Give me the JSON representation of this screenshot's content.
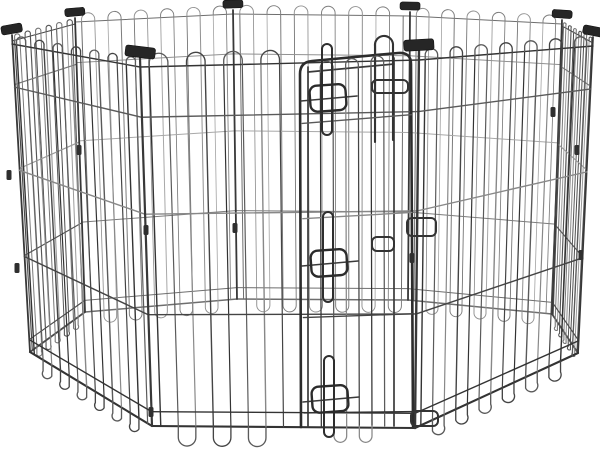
{
  "scene": {
    "background": "#ffffff",
    "subject": "Black foldable metal wire octagonal pet exercise pen, 8 panels with looped wire tops and feet, black plastic corner clips, and a step-through wire door secured by three slide-bolt latches - studio product photo on a white background",
    "panel_count": 8,
    "corner_clip_count": 8,
    "door_latch_count": 3,
    "clip_color": "#262626",
    "wire_dark": "#333333",
    "wire_light": "#999999"
  },
  "pen": {
    "clip_color": "#262626",
    "post_color": "#383838",
    "door_frame_color": "#2c2c2c",
    "latch_color": "#2b2b2b",
    "vertices": {
      "V1": [
        140,
        54
      ],
      "V2": [
        12,
        31
      ],
      "V3": [
        75,
        14
      ],
      "V4": [
        233,
        6
      ],
      "V5": [
        410,
        8
      ],
      "V6": [
        562,
        16
      ],
      "V7": [
        593,
        33
      ],
      "V8": [
        419,
        47
      ],
      "B1": [
        152,
        426
      ],
      "B2": [
        30,
        352
      ],
      "B3": [
        85,
        312
      ],
      "B4": [
        237,
        299
      ],
      "B5": [
        408,
        300
      ],
      "B6": [
        552,
        314
      ],
      "B7": [
        578,
        353
      ],
      "B8": [
        415,
        428
      ]
    },
    "horizontal_fractions": [
      0.14,
      0.41,
      0.69,
      0.96
    ],
    "depths": {
      "front": {
        "base": 13,
        "arc": 4,
        "foot": 11,
        "w": 1.4
      },
      "side": {
        "base": 10,
        "arc": 3,
        "foot": 8,
        "w": 1.15
      },
      "back": {
        "base": 8,
        "arc": 2,
        "foot": 6,
        "w": 1.0
      }
    },
    "palettes": {
      "front": [
        "#333333",
        "#5a5a5a",
        "#888888",
        "#444444"
      ],
      "side": [
        "#4a4a4a",
        "#777777",
        "#999999",
        "#555555"
      ],
      "back": [
        "#6e6e6e",
        "#919191",
        "#a8a8a8",
        "#7c7c7c"
      ]
    },
    "panels_rear": [
      {
        "name": "back-left",
        "a": "V3",
        "b": "V4",
        "ab": "B3",
        "bb": "B4",
        "wires": 12,
        "depth": "back"
      },
      {
        "name": "back-center",
        "a": "V4",
        "b": "V5",
        "ab": "B4",
        "bb": "B5",
        "wires": 13,
        "depth": "back"
      },
      {
        "name": "back-right",
        "a": "V5",
        "b": "V6",
        "ab": "B5",
        "bb": "B6",
        "wires": 12,
        "depth": "back"
      },
      {
        "name": "left-side",
        "a": "V2",
        "b": "V3",
        "ab": "B2",
        "bb": "B3",
        "wires": 12,
        "depth": "side"
      },
      {
        "name": "right-side",
        "a": "V6",
        "b": "V7",
        "ab": "B6",
        "bb": "B7",
        "wires": 12,
        "depth": "side"
      }
    ],
    "panels_front": [
      {
        "name": "front-left",
        "a": "V2",
        "b": "V1",
        "ab": "B2",
        "bb": "B1",
        "wires": 14,
        "depth": "front"
      },
      {
        "name": "front-right",
        "a": "V8",
        "b": "V7",
        "ab": "B8",
        "bb": "B7",
        "wires": 14,
        "depth": "front"
      },
      {
        "name": "front-door",
        "a": "V1",
        "b": "V8",
        "ab": "B1",
        "bb": "B8",
        "wires": 15,
        "depth": "front",
        "cut": [
          296,
          417
        ]
      }
    ],
    "posts_rear": [
      {
        "v": "V3",
        "b": "B3"
      },
      {
        "v": "V4",
        "b": "B4"
      },
      {
        "v": "V5",
        "b": "B5"
      },
      {
        "v": "V6",
        "b": "B6"
      },
      {
        "v": "V2",
        "b": "B2"
      },
      {
        "v": "V7",
        "b": "B7"
      }
    ],
    "posts_front": [
      {
        "v": "V1",
        "b": "B1",
        "wd": 2.2
      },
      {
        "v": "V8",
        "b": "B8",
        "wd": 2.4
      }
    ],
    "door": {
      "frame_path": "M 301 427 L 300 74 Q 300 62 312 61 L 398 53 Q 411 52 411 64 L 413 426",
      "inner_lines": [
        [
          308,
          67,
          308,
          427
        ],
        [
          394,
          58,
          394,
          426
        ],
        [
          308,
          72,
          394,
          64
        ]
      ],
      "tall_loop_path": "M 375 142 L 375 46 A 9 9 0 0 1 393 44 L 393 140",
      "wires": 6,
      "wire_span": [
        314,
        390
      ],
      "wire_top": [
        73,
        65
      ],
      "wire_bottom": 426,
      "keepers": [
        [
          372,
          80,
          408,
          93
        ],
        [
          407,
          218,
          436,
          236
        ],
        [
          372,
          237,
          394,
          251
        ],
        [
          411,
          411,
          438,
          426
        ]
      ],
      "latches": [
        {
          "cx": 327,
          "keeper_y": 98,
          "bolt_top": 44,
          "bolt_bottom": 135
        },
        {
          "cx": 328,
          "keeper_y": 263,
          "bolt_top": 212,
          "bolt_bottom": 302
        },
        {
          "cx": 329,
          "keeper_y": 399,
          "bolt_top": 356,
          "bolt_bottom": 437
        }
      ]
    },
    "top_clips": [
      {
        "v": "V1",
        "w": 30,
        "h": 11,
        "angle": 7
      },
      {
        "v": "V2",
        "w": 21,
        "h": 9,
        "angle": -10
      },
      {
        "v": "V3",
        "w": 20,
        "h": 8,
        "angle": -5
      },
      {
        "v": "V4",
        "w": 20,
        "h": 8,
        "angle": -2
      },
      {
        "v": "V5",
        "w": 20,
        "h": 8,
        "angle": 1
      },
      {
        "v": "V6",
        "w": 20,
        "h": 8,
        "angle": 4
      },
      {
        "v": "V7",
        "w": 21,
        "h": 9,
        "angle": 11
      },
      {
        "v": "V8",
        "w": 30,
        "h": 11,
        "angle": -3
      }
    ],
    "mid_clips": [
      [
        9,
        175
      ],
      [
        17,
        268
      ],
      [
        79,
        150
      ],
      [
        235,
        228
      ],
      [
        553,
        112
      ],
      [
        577,
        150
      ],
      [
        581,
        255
      ],
      [
        146,
        230
      ],
      [
        151,
        412
      ],
      [
        412,
        258
      ]
    ]
  }
}
